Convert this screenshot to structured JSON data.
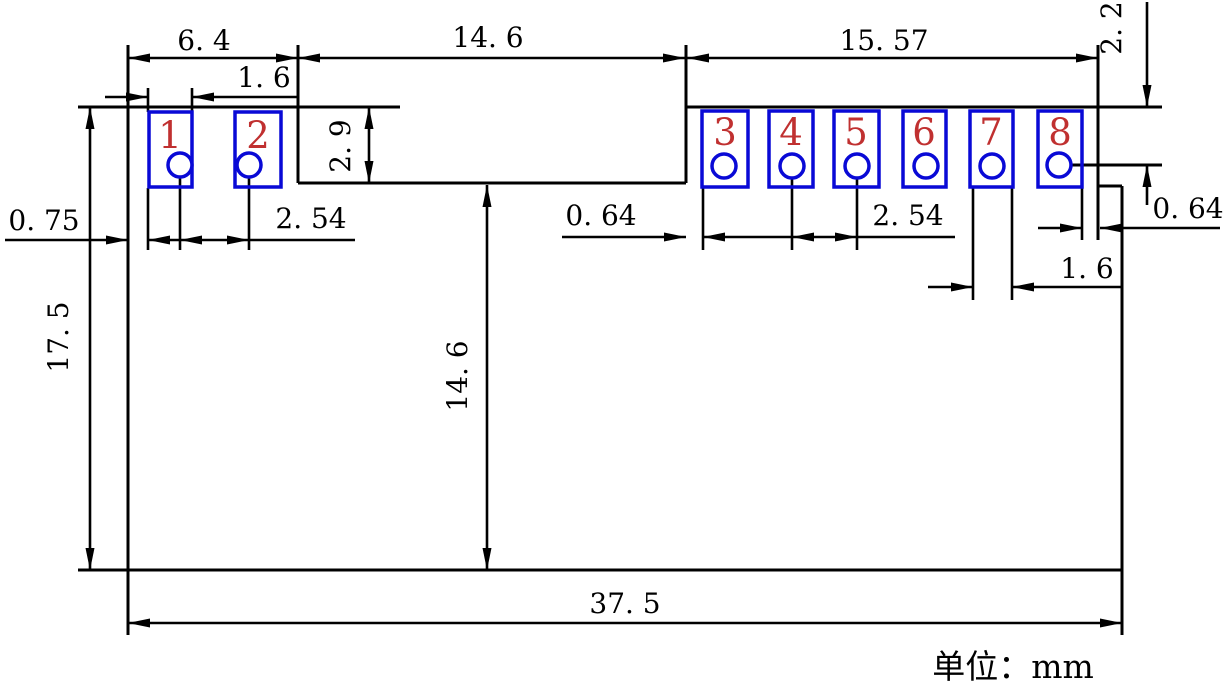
{
  "drawing": {
    "title": "module-footprint-dimension-drawing",
    "unit_label": "单位：mm",
    "pads": [
      {
        "number": "1"
      },
      {
        "number": "2"
      },
      {
        "number": "3"
      },
      {
        "number": "4"
      },
      {
        "number": "5"
      },
      {
        "number": "6"
      },
      {
        "number": "7"
      },
      {
        "number": "8"
      }
    ],
    "dimensions": {
      "top_left_span": "6. 4",
      "pad1_width": "1. 6",
      "top_middle_span": "14. 6",
      "top_right_span": "15. 57",
      "hole_row_offset_right": "2. 2",
      "notch_depth": "2. 9",
      "left_edge_to_pad1": "0. 75",
      "left_hole_pitch": "2. 54",
      "notch_to_pad3_gap": "0. 64",
      "right_hole_pitch": "2. 54",
      "pad8_to_edge_gap": "0. 64",
      "pad7_width": "1. 6",
      "overall_height": "17. 5",
      "notch_height": "14. 6",
      "overall_width": "37. 5"
    },
    "colors": {
      "outline": "#000000",
      "pad_outline": "#0909d6",
      "pad_number": "#c03030",
      "background": "#ffffff"
    }
  }
}
